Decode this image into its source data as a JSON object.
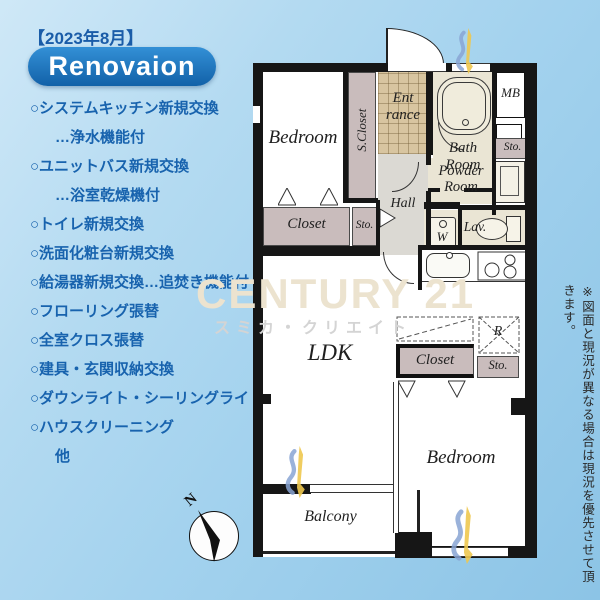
{
  "header": {
    "date": "【2023年8月】",
    "badge": "Renovaion"
  },
  "renovation_list": [
    {
      "text": "○システムキッチン新規交換",
      "indent": false
    },
    {
      "text": "…浄水機能付",
      "indent": true
    },
    {
      "text": "○ユニットバス新規交換",
      "indent": false
    },
    {
      "text": "…浴室乾燥機付",
      "indent": true
    },
    {
      "text": "○トイレ新規交換",
      "indent": false
    },
    {
      "text": "○洗面化粧台新規交換",
      "indent": false
    },
    {
      "text": "○給湯器新規交換…追焚き機能付",
      "indent": false
    },
    {
      "text": "○フローリング張替",
      "indent": false
    },
    {
      "text": "○全室クロス張替",
      "indent": false
    },
    {
      "text": "○建具・玄関収納交換",
      "indent": false
    },
    {
      "text": "○ダウンライト・シーリングライト",
      "indent": false
    },
    {
      "text": "○ハウスクリーニング",
      "indent": false
    },
    {
      "text": "他",
      "indent": true
    }
  ],
  "floorplan": {
    "labels": {
      "bedroom_top": "Bedroom",
      "s_closet": "S.Closet",
      "entrance": "Ent\nrance",
      "hall": "Hall",
      "bath_room": "Bath\nRoom",
      "mb": "MB",
      "sto_top_right": "Sto.",
      "powder_room": "Powder\nRoom",
      "washer": "W",
      "lav": "Lav.",
      "closet_left": "Closet",
      "sto_left": "Sto.",
      "ldk": "LDK",
      "closet_right": "Closet",
      "refrigerator": "R",
      "sto_right": "Sto.",
      "bedroom_bottom": "Bedroom",
      "balcony": "Balcony"
    },
    "compass": {
      "north": "N"
    }
  },
  "watermark": {
    "brand": "CENTURY 21",
    "sub": "スミカ・クリエイト"
  },
  "disclaimer": "※図面と現況が異なる場合は現況を優先させて頂きます。",
  "colors": {
    "accent_blue": "#1a64b0",
    "badge_blue": "#1e72bf",
    "background_blue": "#a7d3ee",
    "closet_pink": "#c9bcbc",
    "entrance_tan": "#d8c5a0",
    "floor_beige": "#eae5d4",
    "hall_gray": "#dbd9d3",
    "wall_black": "#161616",
    "watermark_tan": "#ece3cf",
    "logo_yellow": "#eec84f",
    "logo_blue": "#88a4d4"
  },
  "icons": {
    "compass-needle-icon": "black tilted triangle needle",
    "bathtub-icon": "double rounded rectangle with drain",
    "stove-icon": "three burner circles",
    "sink-icon": "rounded rectangle with faucet dot",
    "toilet-icon": "tank and oval bowl",
    "washer-icon": "square with dot",
    "door-swing-icon": "small outlined triangle",
    "door-arc-icon": "quarter circle arc",
    "logo-mark-icon": "blue swoosh with yellow blade"
  }
}
